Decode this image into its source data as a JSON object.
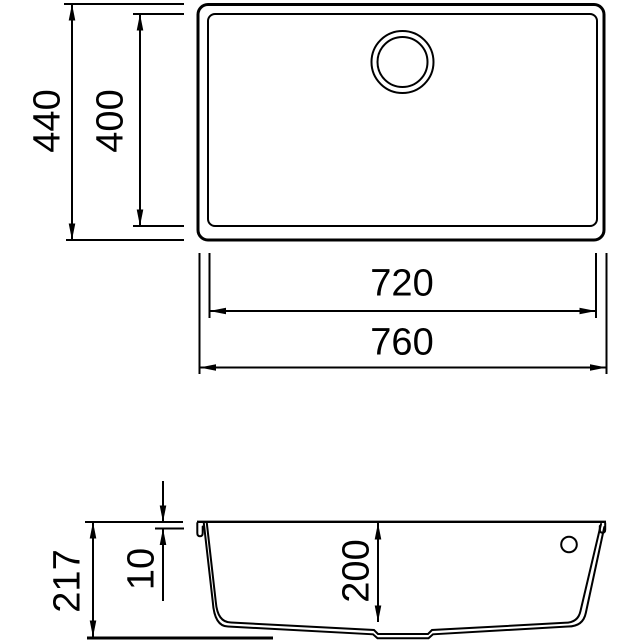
{
  "colors": {
    "line": "#000000",
    "background": "#ffffff"
  },
  "top_view": {
    "overall_depth": "440",
    "bowl_depth": "400",
    "bowl_width": "720",
    "overall_width": "760"
  },
  "section_view": {
    "overall_height": "217",
    "rim_offset": "10",
    "bowl_depth": "200"
  }
}
